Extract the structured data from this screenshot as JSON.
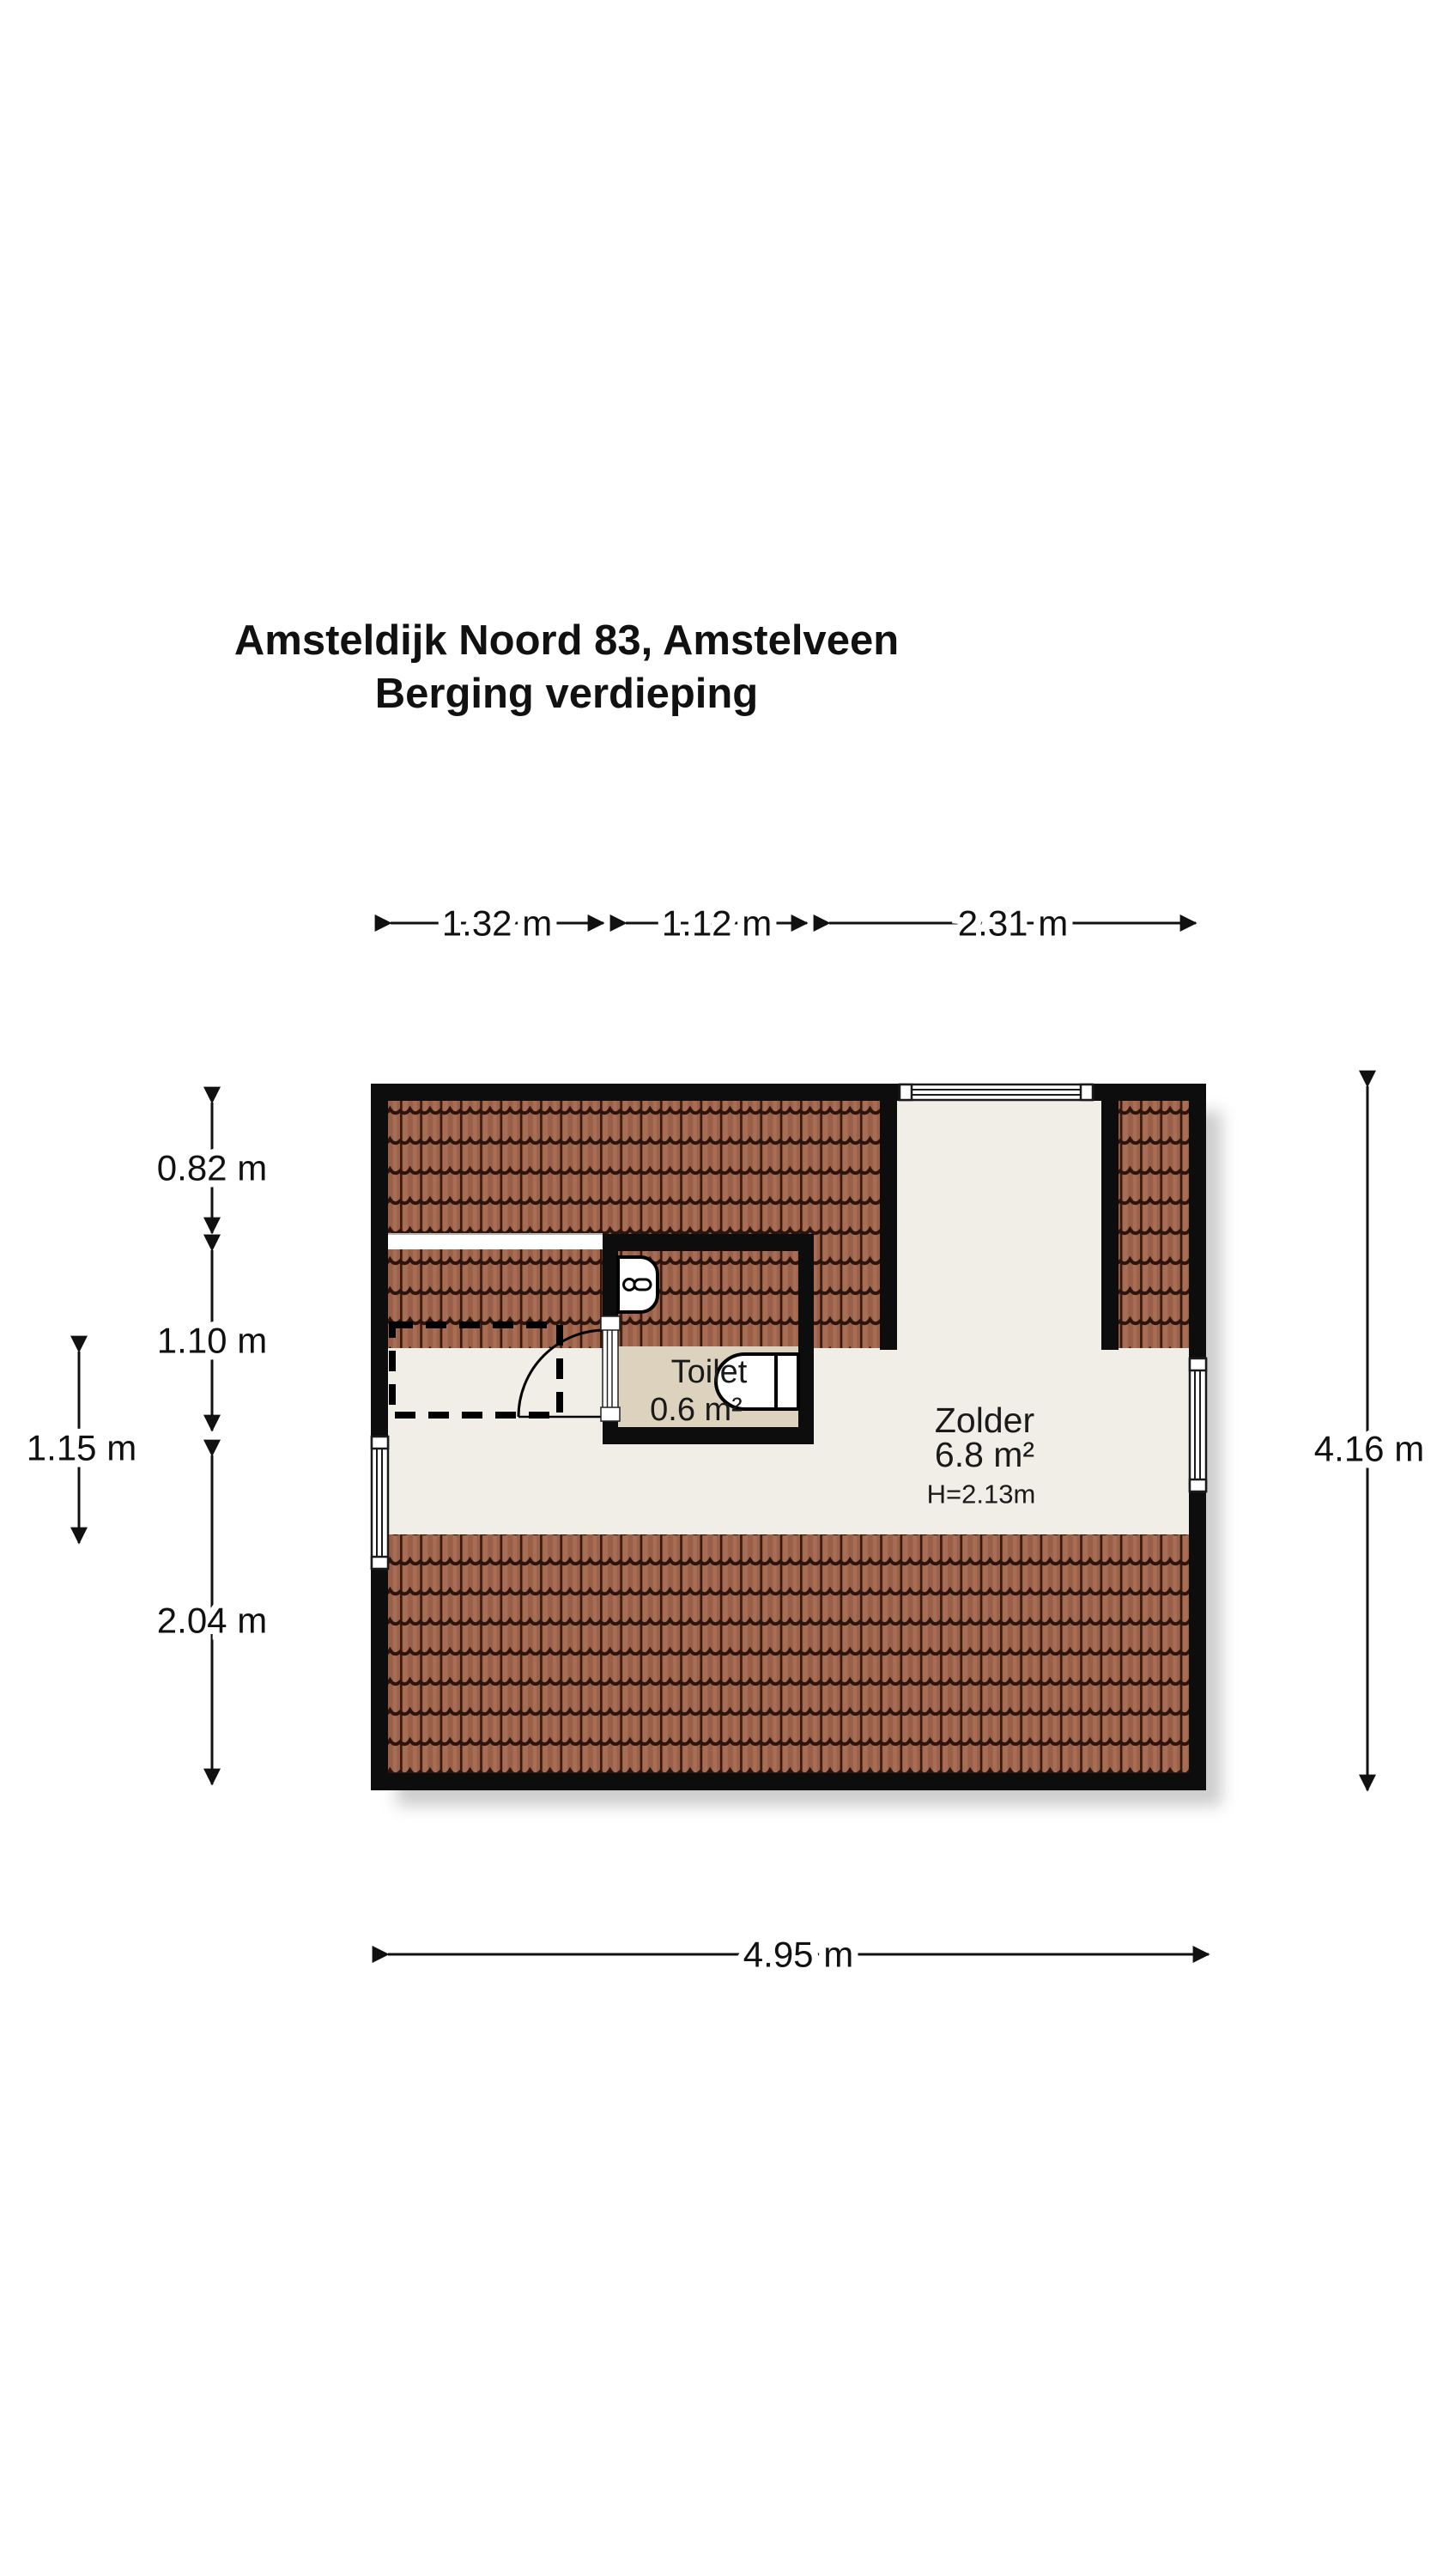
{
  "title": {
    "line1": "Amsteldijk Noord 83, Amstelveen",
    "line2": "Berging verdieping"
  },
  "dimensions": {
    "top": [
      "1.32 m",
      "1.12 m",
      "2.31 m"
    ],
    "left_inner": [
      "0.82 m",
      "1.10 m",
      "2.04 m"
    ],
    "left_outer": "1.15 m",
    "right": "4.16 m",
    "bottom": "4.95 m"
  },
  "rooms": {
    "zolder": {
      "name": "Zolder",
      "area": "6.8 m²",
      "ceiling_height": "H=2.13m"
    },
    "toilet": {
      "name": "Toilet",
      "area": "0.6 m²"
    }
  },
  "colors": {
    "wall": "#0d0d0d",
    "roof_tile_base": "#9c614a",
    "roof_tile_highlight": "#a76e55",
    "roof_tile_dark": "#2c140c",
    "floor": "#f0eee6",
    "toilet_floor": "#ddd2be",
    "background": "#ffffff"
  }
}
